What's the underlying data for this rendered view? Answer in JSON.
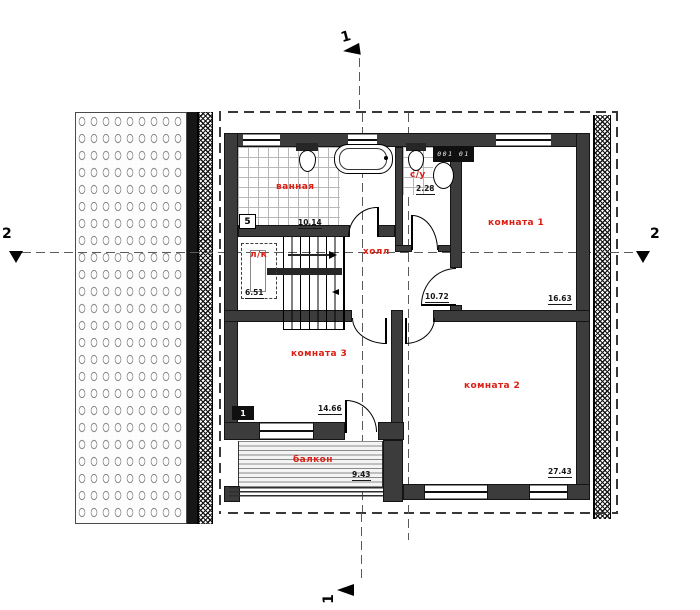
{
  "plan": {
    "rooms": [
      {
        "name": "ванная",
        "area": "10.14"
      },
      {
        "name": "с/у",
        "area": "2.28"
      },
      {
        "name": "комната 1",
        "area": "16.63"
      },
      {
        "name": "холл",
        "area": "10.72"
      },
      {
        "name": "л/к",
        "area": "6.51"
      },
      {
        "name": "комната 3",
        "area": "14.66"
      },
      {
        "name": "комната 2",
        "area": "27.43"
      },
      {
        "name": "балкон",
        "area": "9.43"
      }
    ],
    "section_markers": {
      "top": "1",
      "bottom": "1",
      "left": "2",
      "right": "2"
    },
    "tags": {
      "bath_tag": "5",
      "balcony_tag": "1",
      "vent_label": "001 01"
    },
    "colors": {
      "room_label": "#dc1f14",
      "wall": "#3c3c3c"
    }
  }
}
